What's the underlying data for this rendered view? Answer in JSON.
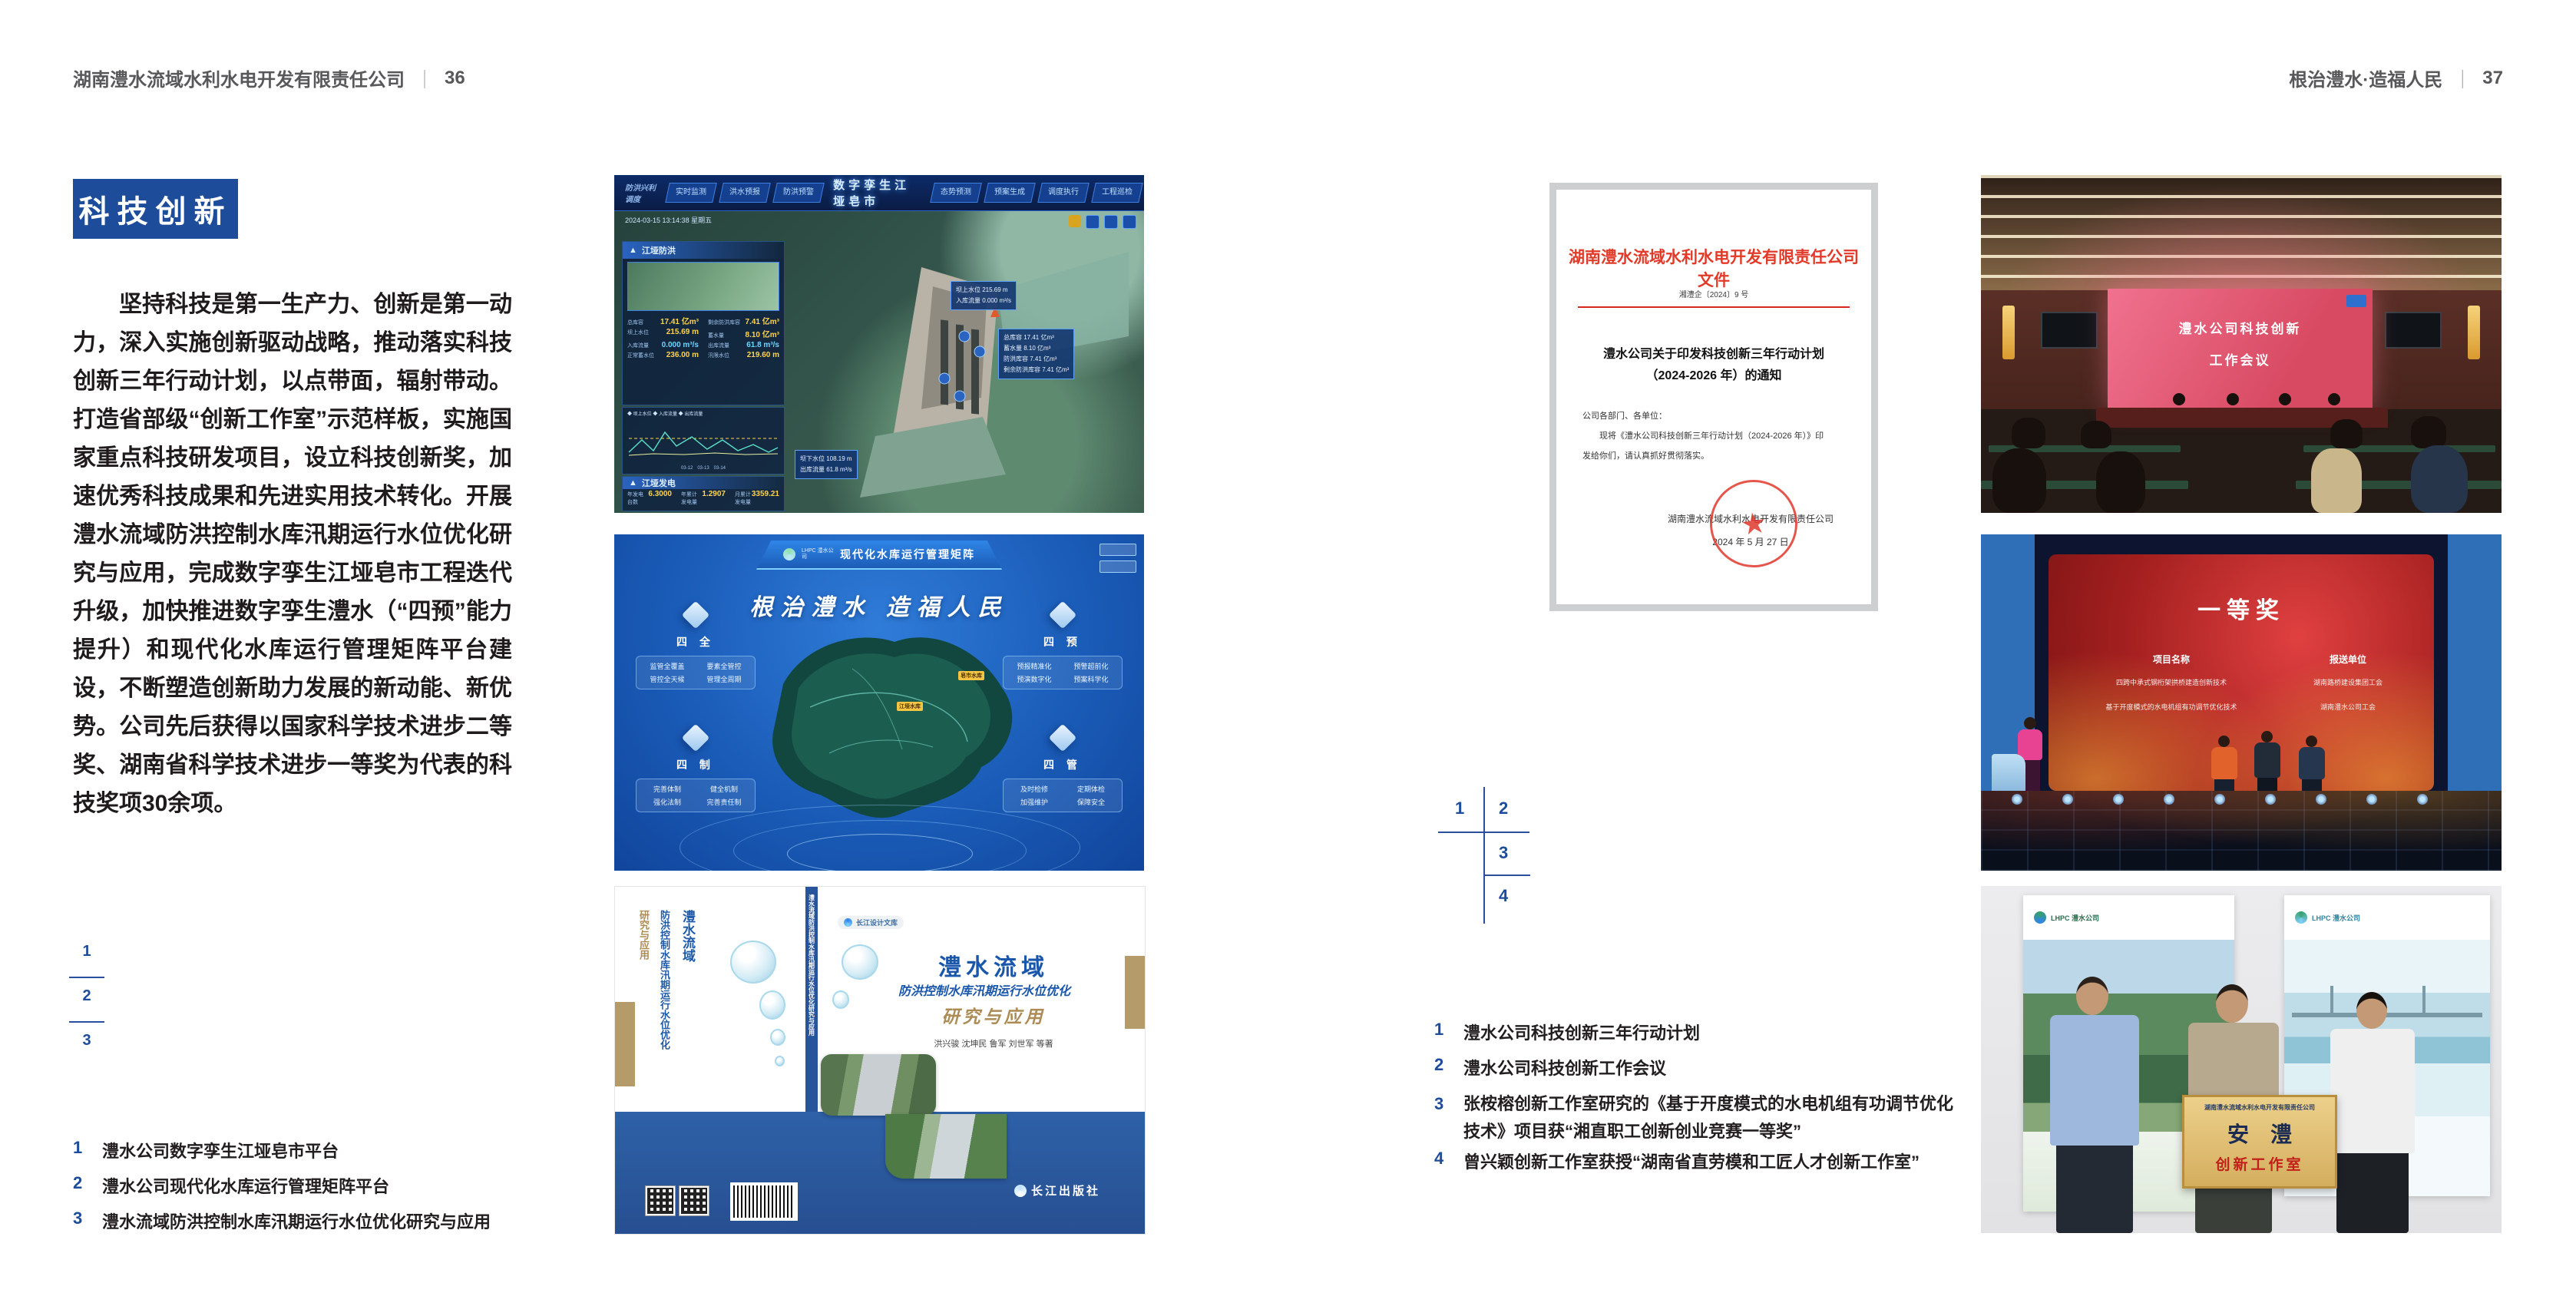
{
  "left_page": {
    "header_title": "湖南澧水流域水利水电开发有限责任公司",
    "header_sep": "｜",
    "page_no": "36",
    "section_title": "科技创新",
    "body": "坚持科技是第一生产力、创新是第一动力，深入实施创新驱动战略，推动落实科技创新三年行动计划，以点带面，辐射带动。打造省部级“创新工作室”示范样板，实施国家重点科技研发项目，设立科技创新奖，加速优秀科技成果和先进实用技术转化。开展澧水流域防洪控制水库汛期运行水位优化研究与应用，完成数字孪生江垭皂市工程迭代升级，加快推进数字孪生澧水（“四预”能力提升）和现代化水库运行管理矩阵平台建设，不断塑造创新助力发展的新动能、新优势。公司先后获得以国家科学技术进步二等奖、湖南省科学技术进步一等奖为代表的科技奖项30余项。",
    "index": {
      "n1": "1",
      "n2": "2",
      "n3": "3"
    },
    "captions": [
      {
        "n": "1",
        "t": "澧水公司数字孪生江垭皂市平台"
      },
      {
        "n": "2",
        "t": "澧水公司现代化水库运行管理矩阵平台"
      },
      {
        "n": "3",
        "t": "澧水流域防洪控制水库汛期运行水位优化研究与应用"
      }
    ]
  },
  "right_page": {
    "header_title": "根治澧水·造福人民",
    "header_sep": "｜",
    "page_no": "37",
    "index": {
      "n1": "1",
      "n2": "2",
      "n3": "3",
      "n4": "4"
    },
    "captions": [
      {
        "n": "1",
        "t": "澧水公司科技创新三年行动计划"
      },
      {
        "n": "2",
        "t": "澧水公司科技创新工作会议"
      },
      {
        "n": "3",
        "t": "张桉榕创新工作室研究的《基于开度模式的水电机组有功调节优化技术》项目获“湘直职工创新创业竞赛一等奖”"
      },
      {
        "n": "4",
        "t": "曾兴颖创新工作室获授“湖南省直劳模和工匠人才创新工作室”"
      }
    ]
  },
  "dashboard": {
    "corner_label": "防洪兴利调度",
    "tabs_left": [
      "实时监测",
      "洪水预报",
      "防洪预警"
    ],
    "title": "数字孪生江垭皂市",
    "tabs_right": [
      "态势预测",
      "预案生成",
      "调度执行",
      "工程巡检"
    ],
    "timestamp": "2024-03-15 13:14:38 星期五",
    "panel1_title": "江垭防洪",
    "p1": [
      {
        "l": "总库容",
        "v": "17.41 亿m³"
      },
      {
        "l": "剩余防洪库容",
        "v": "7.41 亿m³"
      },
      {
        "l": "坝上水位",
        "v": "215.69 m"
      },
      {
        "l": "蓄水量",
        "v": "8.10 亿m³"
      },
      {
        "l": "入库流量",
        "v": "0.000 m³/s"
      },
      {
        "l": "出库流量",
        "v": "61.8 m³/s"
      },
      {
        "l": "正常蓄水位",
        "v": "236.00 m"
      },
      {
        "l": "汛限水位",
        "v": "219.60 m"
      }
    ],
    "chart_legend": "◆ 坝上水位  ◆ 入库流量  ◆ 出库流量",
    "chart_x": "03-12　03-13　03-14",
    "panel2_title": "江垭发电",
    "p2": [
      {
        "l": "年发电台数",
        "v": "6.3000"
      },
      {
        "l": "年累计发电量",
        "v": "1.2907"
      },
      {
        "l": "月累计发电量",
        "v": "3359.21"
      },
      {
        "l": "当前出力",
        "v": "0.00"
      },
      {
        "l": "发电流量",
        "v": "0.00"
      },
      {
        "l": "弃水流量",
        "v": "0.00"
      }
    ],
    "tip1_l1": "坝上水位 215.69 m",
    "tip1_l2": "入库流量 0.000 m³/s",
    "tip2": [
      "总库容 17.41 亿m³",
      "蓄水量 8.10 亿m³",
      "防洪库容 7.41 亿m³",
      "剩余防洪库容 7.41 亿m³"
    ],
    "tip3_l1": "坝下水位 108.19 m",
    "tip3_l2": "出库流量 61.8 m³/s"
  },
  "matrix": {
    "logo": "LHPC 澧水公司",
    "title": "现代化水库运行管理矩阵",
    "slogan": "根治澧水  造福人民",
    "groups": [
      {
        "name": "四 全",
        "items": [
          "监管全覆盖",
          "要素全管控",
          "管控全天候",
          "管理全周期"
        ]
      },
      {
        "name": "四 预",
        "items": [
          "预报精准化",
          "预警超前化",
          "预演数字化",
          "预案科学化"
        ]
      },
      {
        "name": "四 制",
        "items": [
          "完善体制",
          "健全机制",
          "强化法制",
          "完善责任制"
        ]
      },
      {
        "name": "四 管",
        "items": [
          "及时检修",
          "定期体检",
          "加强维护",
          "保障安全"
        ]
      }
    ],
    "marker1": "皂市水库",
    "marker2": "江垭水库"
  },
  "book": {
    "badge": "长江设计文库",
    "title1": "澧水流域",
    "title2": "防洪控制水库汛期运行水位优化",
    "title3": "研究与应用",
    "authors": "洪兴骏  沈坤民  鲁军  刘世军  等著",
    "publisher": "长江出版社",
    "spine": "澧水流域防洪控制水库汛期运行水位优化研究与应用"
  },
  "document": {
    "header": "湖南澧水流域水利水电开发有限责任公司文件",
    "doc_no": "湘澧企〔2024〕9 号",
    "title1": "澧水公司关于印发科技创新三年行动计划",
    "title2": "（2024-2026 年）的通知",
    "salutation": "公司各部门、各单位：",
    "body1": "现将《澧水公司科技创新三年行动计划（2024-2026 年）》印",
    "body2": "发给你们，请认真抓好贯彻落实。",
    "signer": "湖南澧水流域水利水电开发有限责任公司",
    "date": "2024 年 5 月 27 日",
    "seal_star": "★"
  },
  "meeting": {
    "screen1": "澧水公司科技创新",
    "screen2": "工作会议"
  },
  "stage": {
    "award": "一等奖",
    "col1": "项目名称",
    "col1_items": [
      "四跨中承式钢桁架拱桥建造创新技术",
      "基于开度模式的水电机组有功调节优化技术"
    ],
    "col2": "报送单位",
    "col2_items": [
      "湖南路桥建设集团工会",
      "湖南澧水公司工会"
    ]
  },
  "workshop": {
    "plaque_header": "湖南澧水流域水利水电开发有限责任公司",
    "plaque_title": "安　澧",
    "plaque_sub": "创新工作室",
    "logo_left": "LHPC 澧水公司",
    "logo_right": "LHPC 澧水公司"
  }
}
